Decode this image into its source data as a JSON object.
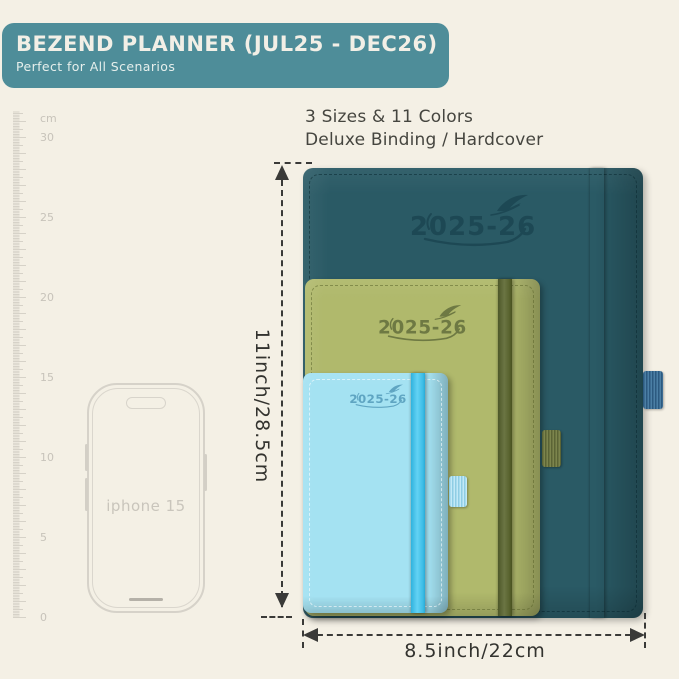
{
  "header": {
    "title": "BEZEND PLANNER (JUL25 - DEC26)",
    "subtitle": "Perfect for All Scenarios"
  },
  "info": {
    "line1": "3 Sizes & 11 Colors",
    "line2": "Deluxe Binding / Hardcover"
  },
  "ruler": {
    "unit": "cm",
    "labels": [
      "30",
      "25",
      "20",
      "15",
      "10",
      "5",
      "0"
    ]
  },
  "phone": {
    "label": "iphone 15"
  },
  "planners": [
    {
      "name": "large-teal",
      "year_label": "2025-26",
      "icon": "feather-icon"
    },
    {
      "name": "medium-green",
      "year_label": "2025-26",
      "icon": "feather-icon"
    },
    {
      "name": "small-blue",
      "year_label": "2025-26",
      "icon": "feather-icon"
    }
  ],
  "dimensions": {
    "height_label": "11inch/28.5cm",
    "width_label": "8.5inch/22cm"
  },
  "colors": {
    "background": "#f4f0e5",
    "banner": "#4e8d99",
    "banner_text": "#f2efe6",
    "planner_large": "#2a5a65",
    "planner_medium": "#b0b96c",
    "planner_small": "#a4e2f2",
    "band_large": "#3f7399",
    "band_medium": "#5f6936",
    "band_small": "#45c4ec",
    "dimension_line": "#3a3a38",
    "ruler": "#cfcbc1"
  }
}
